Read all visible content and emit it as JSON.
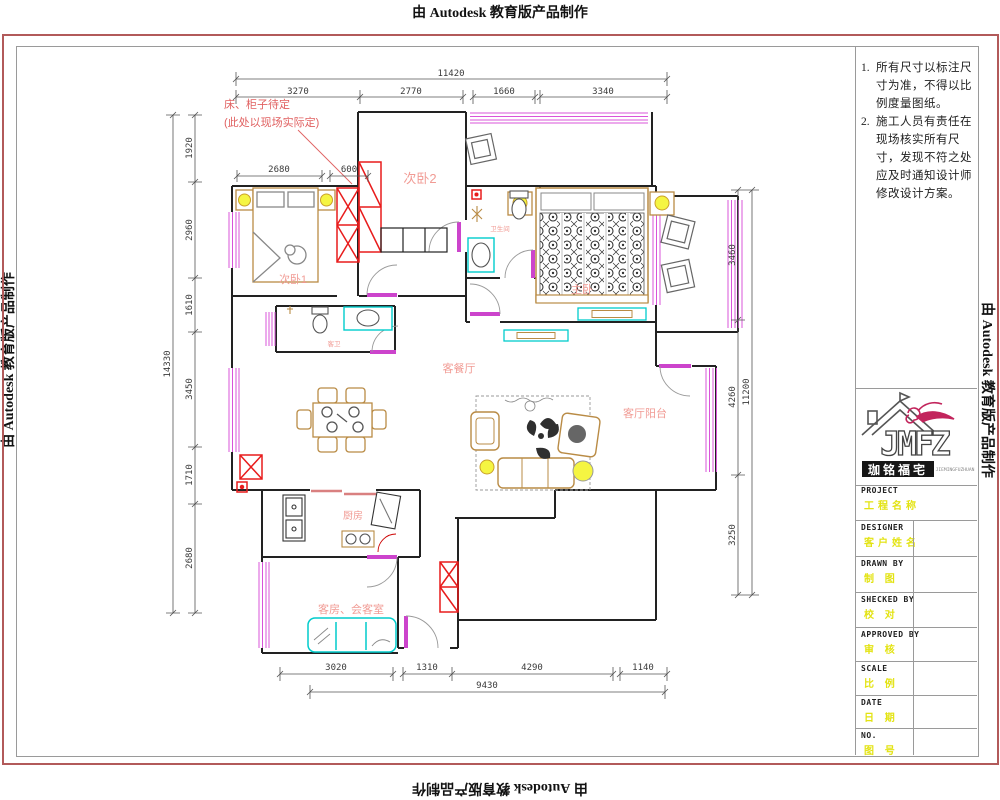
{
  "watermark": {
    "top": "由 Autodesk 教育版产品制作",
    "bottom": "由 Autodesk 教育版产品制作",
    "left": "由 Autodesk 教育版产品制作",
    "right": "由 Autodesk 教育版产品制作"
  },
  "notes": {
    "items": [
      {
        "num": "1.",
        "text": "所有尺寸以标注尺寸为准，不得以比例度量图纸。"
      },
      {
        "num": "2.",
        "text": "施工人员有责任在现场核实所有尺寸，发现不符之处应及时通知设计师修改设计方案。"
      }
    ]
  },
  "logo": {
    "monogram": "JMFZ",
    "chinese": "珈铭福宅",
    "latin_small": "JIEMINGFUZHUAN"
  },
  "title_block": {
    "rows": [
      {
        "label": "PROJECT",
        "value": "工程名称"
      },
      {
        "label": "DESIGNER",
        "value": "客户姓名"
      },
      {
        "label": "DRAWN BY",
        "value": "制 图"
      },
      {
        "label": "SHECKED BY",
        "value": "校 对"
      },
      {
        "label": "APPROVED BY",
        "value": "审 核"
      },
      {
        "label": "SCALE",
        "value": "比 例"
      },
      {
        "label": "DATE",
        "value": "日 期"
      },
      {
        "label": "NO.",
        "value": "图 号"
      }
    ]
  },
  "annotation": {
    "line1": "床、柜子待定",
    "line2": "(此处以现场实际定)"
  },
  "rooms": {
    "bedroom2": "次卧2",
    "bedroom1": "次卧1",
    "master": "主卧",
    "master_bath": "卫生间",
    "guest_bath": "客卫",
    "living_dining": "客餐厅",
    "living_balcony": "客厅阳台",
    "kitchen": "厨房",
    "guest_room": "客房、会客室"
  },
  "dimensions": {
    "top_total": "11420",
    "top": [
      "3270",
      "2770",
      "1660",
      "3340"
    ],
    "left_total": "14330",
    "left": [
      "1920",
      "2960",
      "1610",
      "3450",
      "1710",
      "2680"
    ],
    "right_total": "11200",
    "right": [
      "3460",
      "4260",
      "3250"
    ],
    "bottom_total": "9430",
    "bottom": [
      "3020",
      "1310",
      "4290",
      "1140"
    ],
    "inner": [
      "2680",
      "600"
    ]
  },
  "colors": {
    "wall": "#222222",
    "window_magenta": "#d954d9",
    "furniture_wood": "#b98b45",
    "fixture_cyan": "#00cccc",
    "cabinet_red": "#e81c1c",
    "lamp_yellow": "#f5f542",
    "label_salmon": "#f19b94",
    "sheet_border_red": "#b25a5a",
    "title_value_yellow": "#e3e312"
  }
}
